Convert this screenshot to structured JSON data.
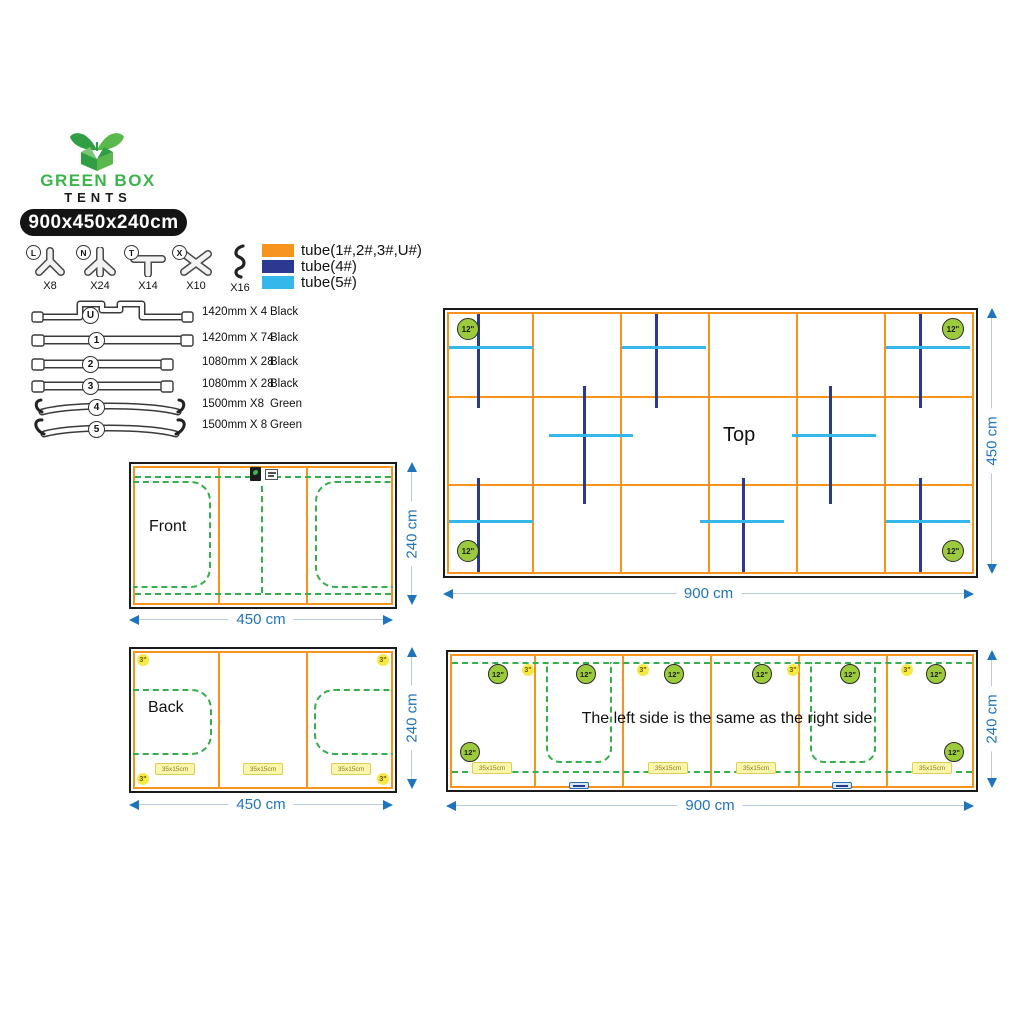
{
  "brand": {
    "name": "GREEN BOX",
    "tagline": "TENTS",
    "size": "900x450x240cm"
  },
  "connectors": [
    {
      "letter": "L",
      "qty": "X8"
    },
    {
      "letter": "N",
      "qty": "X24"
    },
    {
      "letter": "T",
      "qty": "X14"
    },
    {
      "letter": "X",
      "qty": "X10"
    },
    {
      "letter": "",
      "qty": "X16"
    }
  ],
  "legend": [
    {
      "label": "tube(1#,2#,3#,U#)",
      "color": "#F7941E"
    },
    {
      "label": "tube(4#)",
      "color": "#2B3990"
    },
    {
      "label": "tube(5#)",
      "color": "#35B7EC"
    }
  ],
  "tubes": [
    {
      "no": "U",
      "spec": "1420mm X 4",
      "color": "Black"
    },
    {
      "no": "1",
      "spec": "1420mm X 74",
      "color": "Black"
    },
    {
      "no": "2",
      "spec": "1080mm X 28",
      "color": "Black"
    },
    {
      "no": "3",
      "spec": "1080mm X 28",
      "color": "Black"
    },
    {
      "no": "4",
      "spec": "1500mm X8",
      "color": "Green"
    },
    {
      "no": "5",
      "spec": "1500mm X 8",
      "color": "Green"
    }
  ],
  "panels": {
    "top": "Top",
    "front": "Front",
    "back": "Back"
  },
  "side_note": "The left side is the same as the right side",
  "vents": {
    "d12": "12\"",
    "d3": "3\""
  },
  "window_badge": "35x15cm",
  "dims": {
    "cm900": "900 cm",
    "cm450": "450 cm",
    "cm240": "240 cm"
  },
  "colors": {
    "orange": "#F7941E",
    "tube4": "#2B3990",
    "tube5": "#35B7EC",
    "green_dotted": "#33AF4B",
    "vent_lime": "#9BCB3C",
    "vent_yellow": "#F6E943",
    "dimension_blue": "#1F74BE"
  }
}
